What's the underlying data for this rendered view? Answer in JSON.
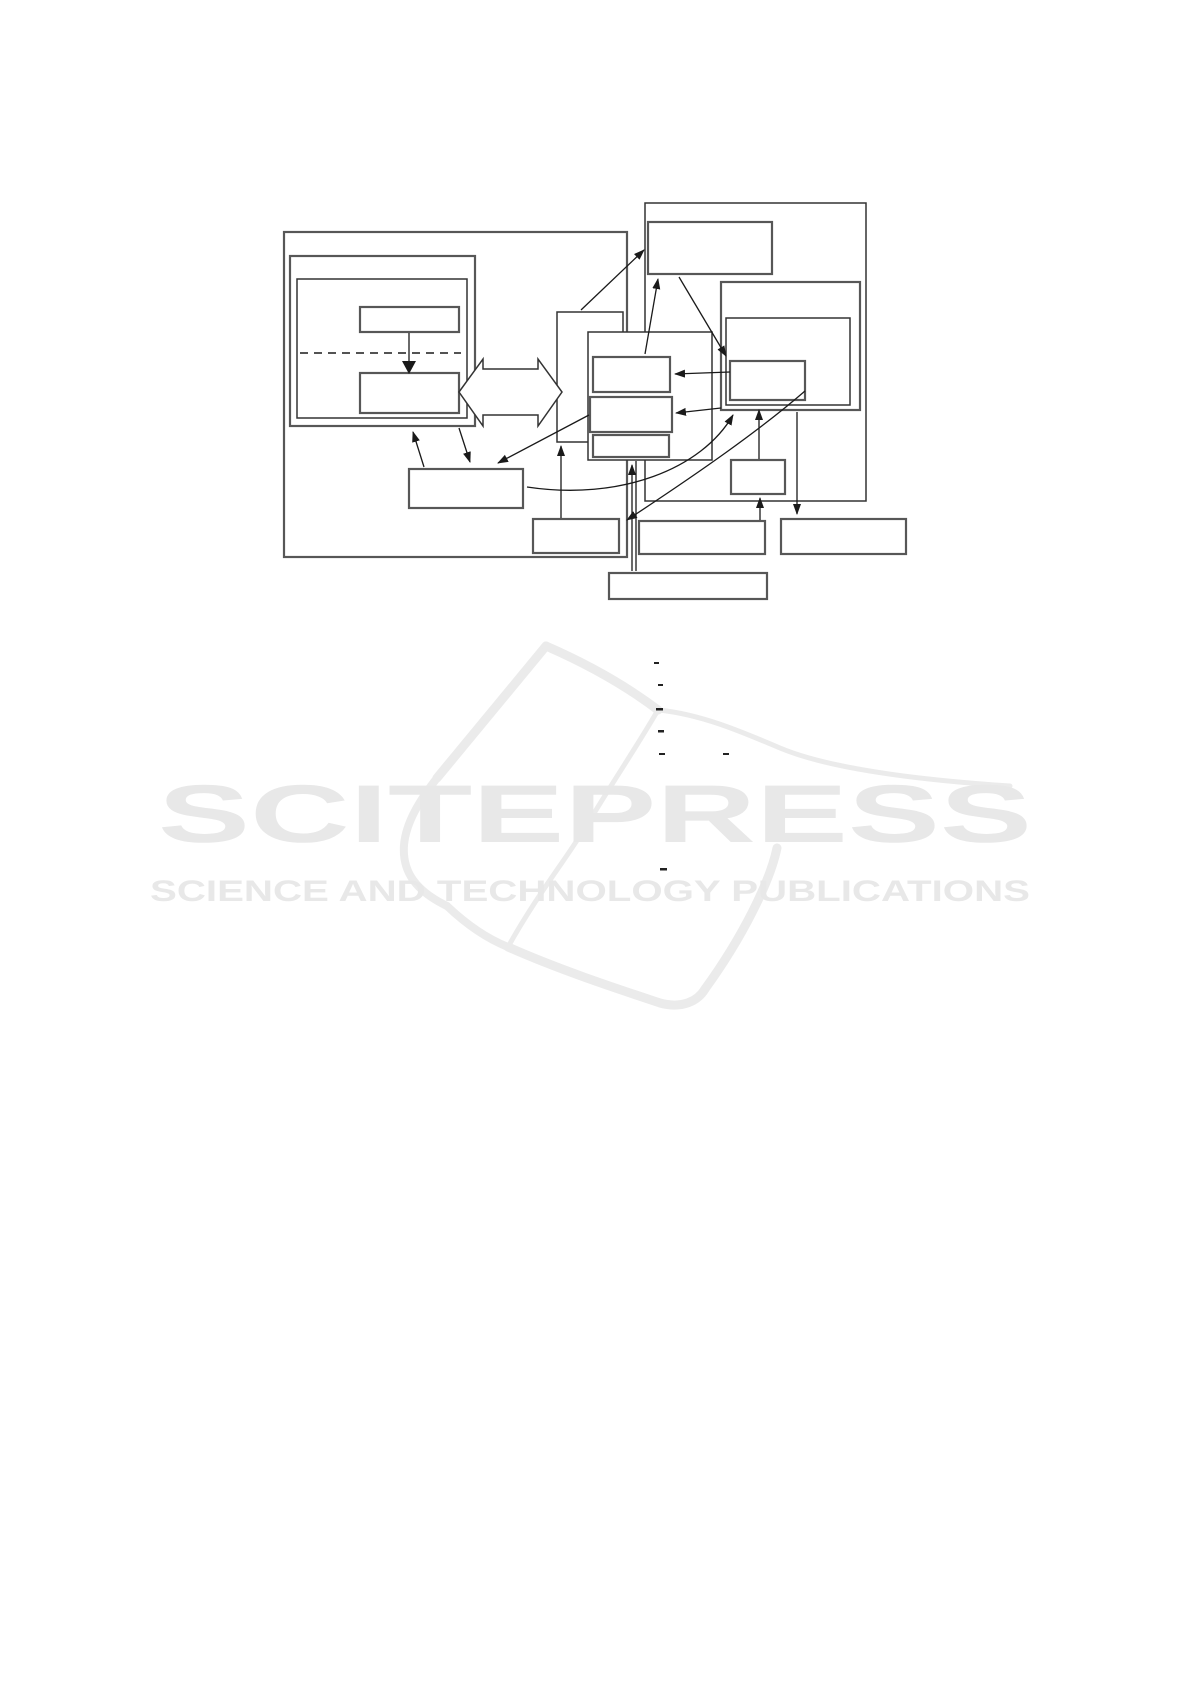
{
  "page": {
    "background": "#ffffff"
  },
  "watermark": {
    "title": "SCITEPRESS",
    "subtitle": "SCIENCE AND TECHNOLOGY PUBLICATIONS",
    "text_color": "#e8e8e8",
    "stroke_color": "#ebebeb",
    "book_paths": [
      {
        "d": "M437,778 L546,646",
        "w": 9
      },
      {
        "d": "M546,646 C585,663 625,685 658,710",
        "w": 9
      },
      {
        "d": "M658,710 C700,714 740,731 780,748 C830,769 920,780 1010,786",
        "w": 5
      },
      {
        "d": "M658,710 C636,748 612,783 590,820 C568,857 538,893 508,947",
        "w": 5
      },
      {
        "d": "M437,778 C420,800 406,822 404,845 C402,872 416,891 447,906",
        "w": 8
      },
      {
        "d": "M447,906 C467,925 488,939 508,947",
        "w": 8
      },
      {
        "d": "M508,947 C560,970 615,988 660,1003 C682,1009 698,1001 705,989",
        "w": 9
      },
      {
        "d": "M777,848 C770,882 742,938 705,989",
        "w": 9
      }
    ]
  },
  "diagram": {
    "container_color": "#333333",
    "box_border_color": "#575757",
    "line_color": "#1a1a1a",
    "dash_color": "#222222",
    "boxes": [
      {
        "id": "outer-left-container",
        "x": 284,
        "y": 232,
        "w": 343,
        "h": 325,
        "s": "box"
      },
      {
        "id": "left-double-outer",
        "x": 290,
        "y": 256,
        "w": 185,
        "h": 170,
        "s": "box"
      },
      {
        "id": "left-double-inner",
        "x": 297,
        "y": 279,
        "w": 170,
        "h": 139,
        "s": "container"
      },
      {
        "id": "left-top-box",
        "x": 360,
        "y": 307,
        "w": 99,
        "h": 25,
        "s": "box"
      },
      {
        "id": "left-lower-box",
        "x": 360,
        "y": 373,
        "w": 99,
        "h": 40,
        "s": "box"
      },
      {
        "id": "right-container",
        "x": 645,
        "y": 203,
        "w": 221,
        "h": 298,
        "s": "container"
      },
      {
        "id": "top-right-box",
        "x": 648,
        "y": 222,
        "w": 124,
        "h": 52,
        "s": "box"
      },
      {
        "id": "right-double-outer",
        "x": 721,
        "y": 282,
        "w": 139,
        "h": 128,
        "s": "box"
      },
      {
        "id": "right-double-inner",
        "x": 726,
        "y": 318,
        "w": 124,
        "h": 87,
        "s": "container"
      },
      {
        "id": "right-small-inner-box",
        "x": 730,
        "y": 361,
        "w": 75,
        "h": 39,
        "s": "box"
      },
      {
        "id": "tall-middle-box",
        "x": 557,
        "y": 312,
        "w": 66,
        "h": 130,
        "s": "container"
      },
      {
        "id": "stacked-container",
        "x": 588,
        "y": 332,
        "w": 124,
        "h": 128,
        "s": "container"
      },
      {
        "id": "stacked-box-1",
        "x": 593,
        "y": 357,
        "w": 77,
        "h": 35,
        "s": "box"
      },
      {
        "id": "stacked-box-2",
        "x": 590,
        "y": 397,
        "w": 82,
        "h": 35,
        "s": "box"
      },
      {
        "id": "stacked-box-3",
        "x": 593,
        "y": 435,
        "w": 76,
        "h": 22,
        "s": "box"
      },
      {
        "id": "right-connector-box",
        "x": 731,
        "y": 460,
        "w": 54,
        "h": 34,
        "s": "box"
      },
      {
        "id": "left-wide-box",
        "x": 409,
        "y": 469,
        "w": 114,
        "h": 39,
        "s": "box"
      },
      {
        "id": "bottom-left-box",
        "x": 533,
        "y": 519,
        "w": 86,
        "h": 34,
        "s": "box"
      },
      {
        "id": "bottom-middle-box",
        "x": 639,
        "y": 521,
        "w": 126,
        "h": 33,
        "s": "box"
      },
      {
        "id": "bottom-right-box",
        "x": 781,
        "y": 519,
        "w": 125,
        "h": 35,
        "s": "box"
      },
      {
        "id": "bottom-wide-box",
        "x": 609,
        "y": 573,
        "w": 158,
        "h": 26,
        "s": "box"
      }
    ],
    "dashed_line": {
      "x1": 300,
      "y1": 353,
      "x2": 461,
      "y2": 353
    },
    "double_arrow": {
      "points": "459,392 483,359 483,369 538,369 538,359 562,392 538,426 538,415 483,415 483,426"
    },
    "triangle_head": {
      "points": "402,361 416,361 409,374"
    },
    "lines": [
      {
        "x1": 409,
        "y1": 333,
        "x2": 409,
        "y2": 361,
        "arrow": false
      },
      {
        "x1": 424,
        "y1": 467,
        "x2": 413,
        "y2": 432,
        "arrow": true
      },
      {
        "x1": 459,
        "y1": 428,
        "x2": 470,
        "y2": 462,
        "arrow": true
      },
      {
        "x1": 589,
        "y1": 415,
        "x2": 498,
        "y2": 463,
        "arrow": true
      },
      {
        "x1": 721,
        "y1": 408,
        "x2": 676,
        "y2": 413,
        "arrow": true
      },
      {
        "x1": 730,
        "y1": 372,
        "x2": 675,
        "y2": 374,
        "arrow": true
      },
      {
        "x1": 581,
        "y1": 310,
        "x2": 644,
        "y2": 250,
        "arrow": true
      },
      {
        "x1": 645,
        "y1": 354,
        "x2": 658,
        "y2": 279,
        "arrow": true
      },
      {
        "x1": 679,
        "y1": 277,
        "x2": 726,
        "y2": 356,
        "arrow": true
      },
      {
        "x1": 561,
        "y1": 518,
        "x2": 561,
        "y2": 446,
        "arrow": true
      },
      {
        "x1": 760,
        "y1": 520,
        "x2": 760,
        "y2": 498,
        "arrow": true
      },
      {
        "x1": 759,
        "y1": 459,
        "x2": 759,
        "y2": 410,
        "arrow": true
      },
      {
        "x1": 797,
        "y1": 412,
        "x2": 797,
        "y2": 514,
        "arrow": true
      },
      {
        "x1": 632,
        "y1": 571,
        "x2": 632,
        "y2": 465,
        "arrow": true
      },
      {
        "x1": 636,
        "y1": 571,
        "x2": 636,
        "y2": 461,
        "arrow": false
      }
    ],
    "curves": [
      {
        "d": "M527,487 C620,501 702,469 733,415",
        "arrow": true
      },
      {
        "d": "M805,391 C760,430 700,472 627,520",
        "arrow": true
      }
    ],
    "dashes": [
      {
        "x": 654,
        "y": 662,
        "w": 5,
        "h": 2
      },
      {
        "x": 658,
        "y": 684,
        "w": 5,
        "h": 2
      },
      {
        "x": 656,
        "y": 708,
        "w": 7,
        "h": 2.5
      },
      {
        "x": 658,
        "y": 730,
        "w": 6,
        "h": 2.5
      },
      {
        "x": 659,
        "y": 753,
        "w": 6,
        "h": 2
      },
      {
        "x": 723,
        "y": 753,
        "w": 6,
        "h": 2
      },
      {
        "x": 660,
        "y": 868,
        "w": 7,
        "h": 2.5
      }
    ]
  }
}
